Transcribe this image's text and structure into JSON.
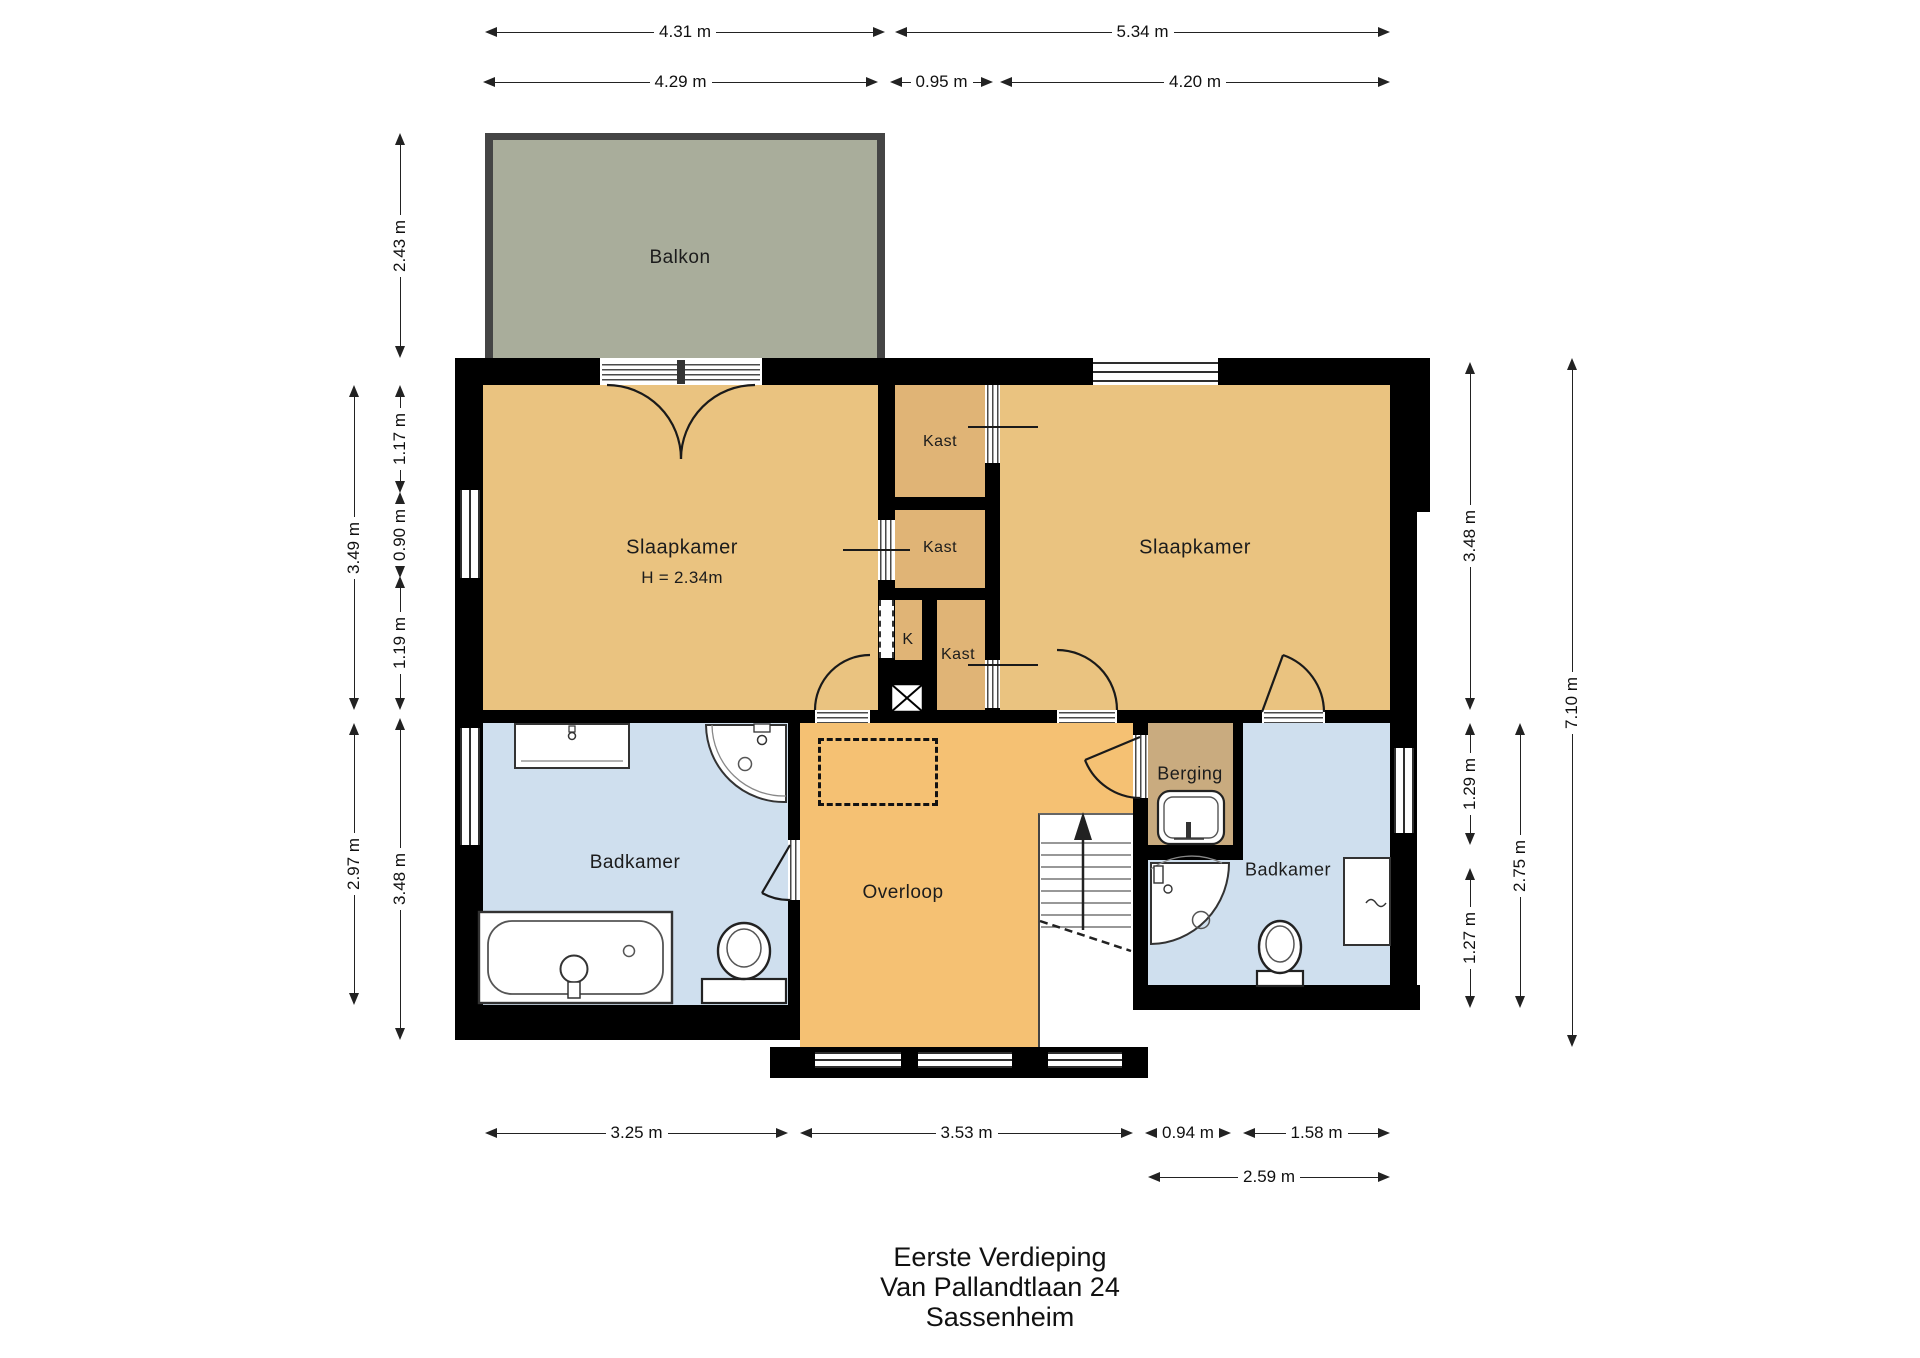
{
  "title": {
    "line1": "Eerste Verdieping",
    "line2": "Van Pallandtlaan 24",
    "line3": "Sassenheim"
  },
  "rooms": {
    "balkon": {
      "label": "Balkon"
    },
    "slaapkamer_left": {
      "label": "Slaapkamer",
      "height_note": "H = 2.34m"
    },
    "slaapkamer_right": {
      "label": "Slaapkamer"
    },
    "kast_top": {
      "label": "Kast"
    },
    "kast_middle": {
      "label": "Kast"
    },
    "kast_bottom": {
      "label": "Kast"
    },
    "k_shaft": {
      "label": "K"
    },
    "berging": {
      "label": "Berging"
    },
    "badkamer_left": {
      "label": "Badkamer"
    },
    "badkamer_right": {
      "label": "Badkamer"
    },
    "overloop": {
      "label": "Overloop"
    }
  },
  "dimensions": {
    "top_row": [
      "4.31 m",
      "5.34 m"
    ],
    "second_row": [
      "4.29 m",
      "0.95 m",
      "4.20 m"
    ],
    "left_outer": [
      "3.49 m",
      "2.97 m"
    ],
    "left_inner": [
      "2.43 m",
      "1.17 m",
      "0.90 m",
      "1.19 m",
      "3.48 m"
    ],
    "right_inner": [
      "3.48 m",
      "1.29 m",
      "1.27 m"
    ],
    "right_middle": [
      "2.75 m"
    ],
    "right_outer": [
      "7.10 m"
    ],
    "bottom_row": [
      "3.25 m",
      "3.53 m",
      "0.94 m",
      "1.58 m"
    ],
    "bottom_row2": [
      "2.59 m"
    ]
  },
  "colors": {
    "bedroom": "#eac380",
    "closet": "#e0b476",
    "hall": "#f5c173",
    "storage": "#c9ab7f",
    "bathroom": "#cfdfee",
    "balcony": "#a9ad9b",
    "wall": "#000000"
  }
}
